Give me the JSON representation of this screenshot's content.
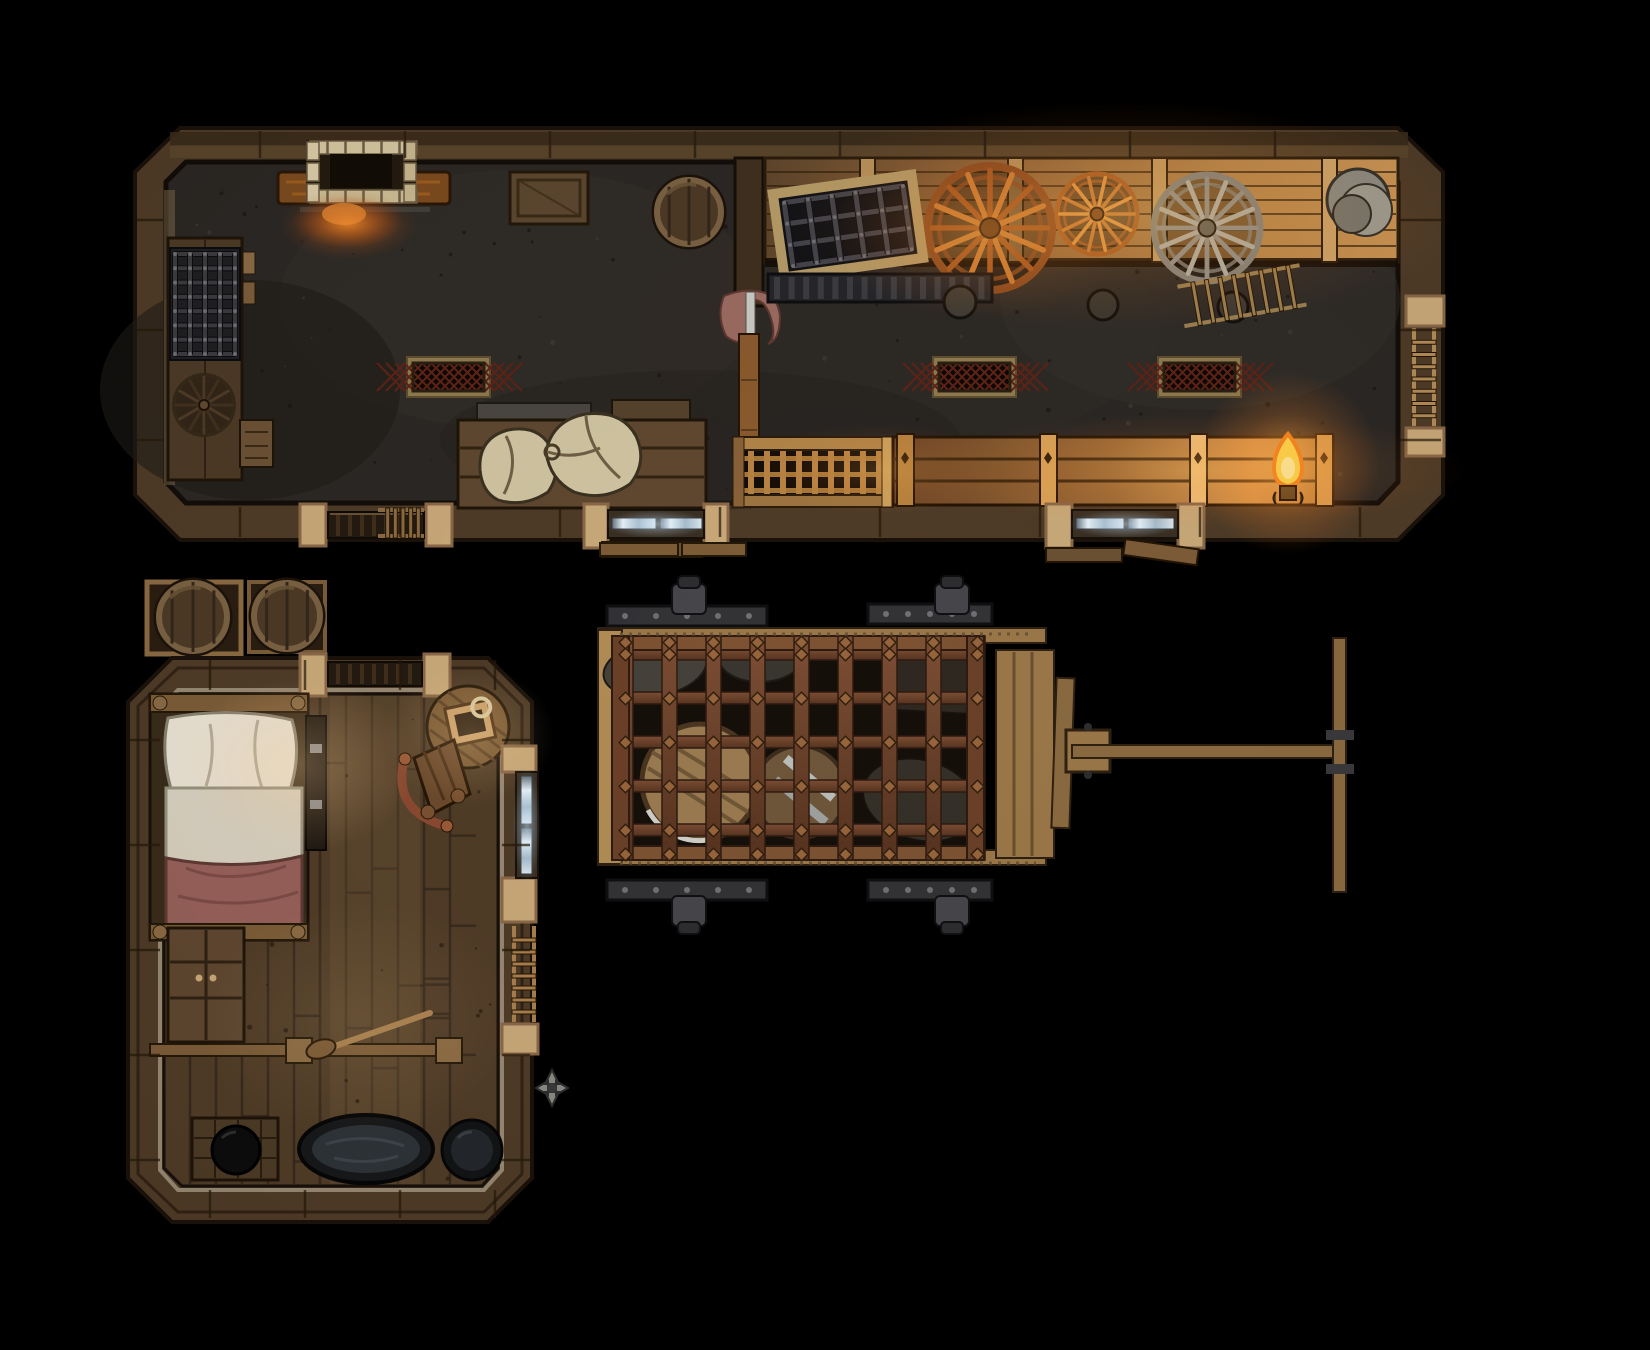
{
  "canvas": {
    "width": 1650,
    "height": 1350,
    "background": "#000000"
  },
  "scene": {
    "label": "Top-down fantasy battle map: wheelwright storeroom, bedroom and a prison wagon in a dark yard",
    "rooms": {
      "storeroom": {
        "label": "Long storeroom and wheelwright workshop",
        "objects": [
          "brick fireplace hearth with embers",
          "iron cage rack on side table",
          "spare dark wagon wheel on table",
          "small crate",
          "storage crate",
          "round wooden barrel",
          "support post with hanging red cloth",
          "lit wall shelf holding three wagon wheels",
          "leaning iron grate panel",
          "dark iron tool rack",
          "stack of metal plates",
          "three lattice floor vents",
          "low bench with two tied grain sacks",
          "latticed crate",
          "row of lamplit crates",
          "burning candle in a bottle",
          "ladder on outside of right wall",
          "slatted wooden door",
          "two steel-banded double doors with stone jambs"
        ]
      },
      "bedroom": {
        "label": "Bedroom with bathing corner",
        "objects": [
          "single bed with pillow, white sheet and red blanket",
          "dark door panel beside bed",
          "round side table with ring-handled satchel",
          "curved-back wooden chair",
          "low cabinet",
          "room divider railing with posts",
          "broom on the floor",
          "wooden wash deck",
          "black iron cauldron",
          "oval bathtub full of dark water",
          "round wash basin",
          "glowing doorway in right wall",
          "ladder on outside of right wall",
          "slatted door in top wall",
          "metal caltrop wall fixture"
        ]
      },
      "yard": {
        "label": "Dark yard between the rooms",
        "objects": [
          "two barrels resting on square pallets",
          "prison wagon with rusted iron cage",
          "barrels, sacks and crates locked inside the cage",
          "four dark iron axle wheels",
          "wooden tow pole ending in a T-handle"
        ]
      }
    },
    "lighting": [
      "orange ember glow under the fireplace",
      "warm lamplight across the wheel shelf",
      "bright candle flame beside the crate row",
      "soft lamplight over the bed and round table",
      "pale blue-white glow inside each doorway"
    ]
  },
  "palette": {
    "bg": "#000000",
    "wall-wood": "#4e3b27",
    "wall-wood-dark": "#3a2b1a",
    "wall-wood-light": "#63492d",
    "wall-edge": "#1a120a",
    "stone-block": "#c8a878",
    "stone-line": "#8a6848",
    "floor-stone": "#2b2724",
    "floor-wood": "#503c27",
    "plank-line": "#2f2113",
    "lit-wood": "#c08848",
    "lit-wood-bright": "#eec57e",
    "iron-dark": "#2d2d30",
    "iron-mid": "#46464a",
    "iron-light": "#707074",
    "rust": "#6e4430",
    "rust-light": "#96643c",
    "grate-frame": "#b49a66",
    "vent-lattice": "#5f2316",
    "sack": "#cfc3a0",
    "pillow": "#e9e1d2",
    "sheet": "#d7cfbe",
    "blanket": "#966059",
    "barrel-body": "#4c3a26",
    "barrel-rim": "#7a6142",
    "cart-wood": "#9a7748",
    "door-metal": "#aebfca",
    "flame": "#ffd84d",
    "flame-deep": "#f5851f",
    "brick": "#d3c59e",
    "cloth": "#9a6a60",
    "water": "#2e3338",
    "steel": "#c6c8c6"
  }
}
